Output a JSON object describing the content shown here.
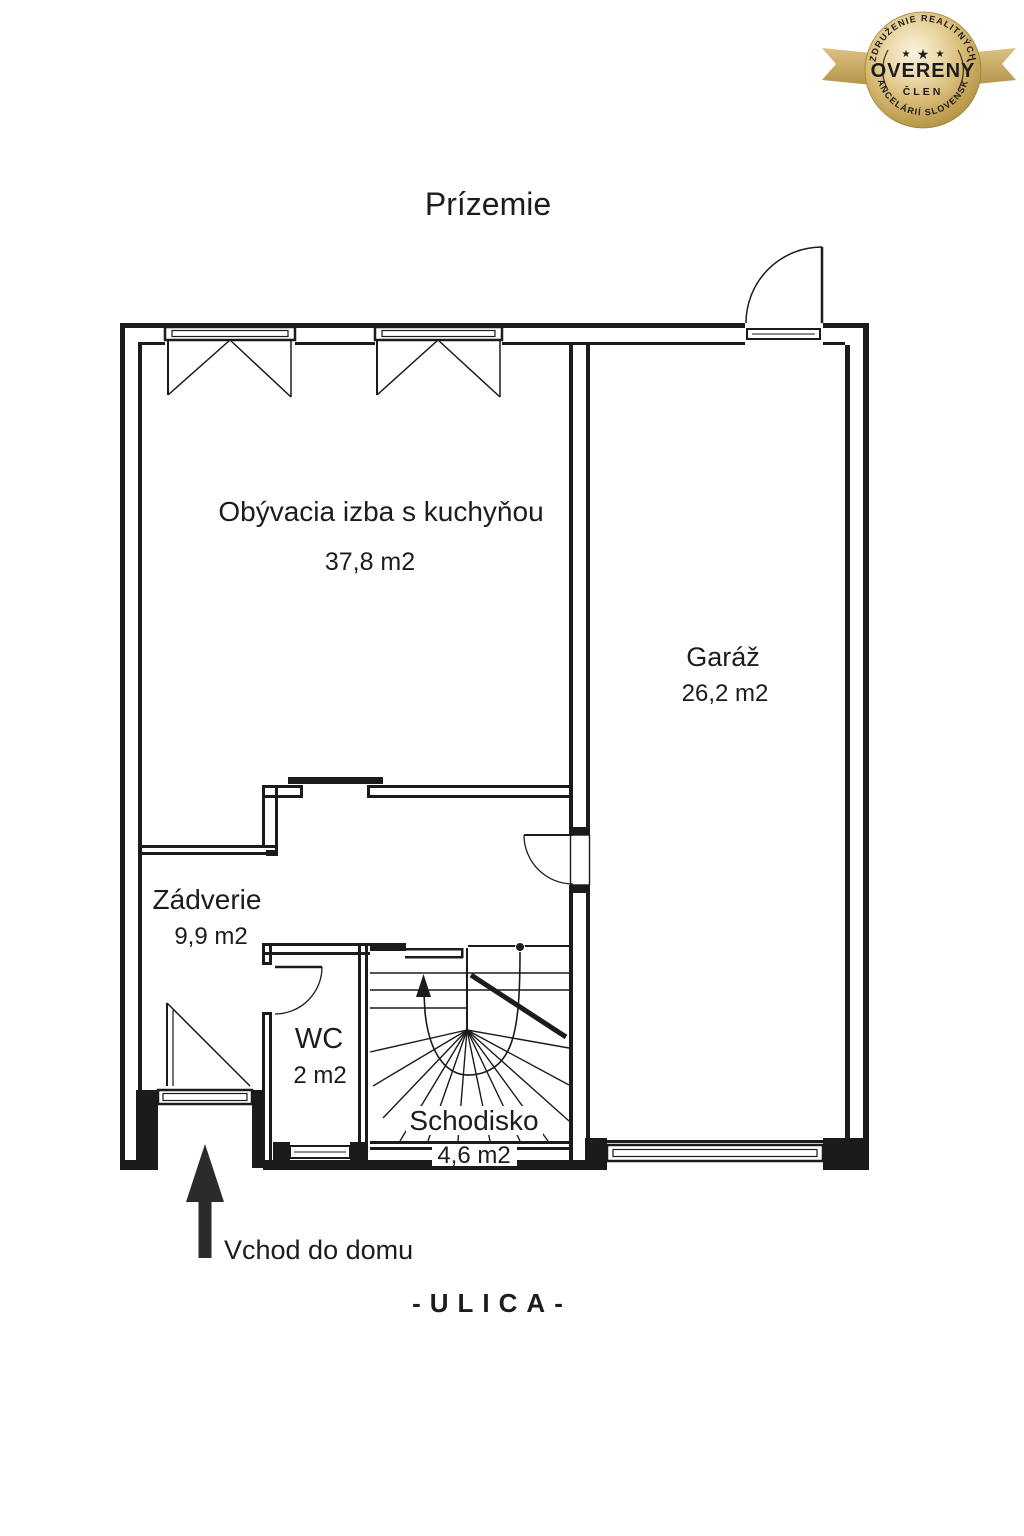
{
  "page": {
    "title": "Prízemie",
    "entrance_label": "Vchod do domu",
    "street_label": "-ULICA-"
  },
  "rooms": {
    "living": {
      "name": "Obývacia izba s kuchyňou",
      "area": "37,8 m2"
    },
    "garage": {
      "name": "Garáž",
      "area": "26,2 m2"
    },
    "hall": {
      "name": "Zádverie",
      "area": "9,9 m2"
    },
    "wc": {
      "name": "WC",
      "area": "2 m2"
    },
    "staircase": {
      "name": "Schodisko",
      "area": "4,6 m2"
    }
  },
  "badge": {
    "main": "OVERENÝ",
    "member": "ČLEN",
    "arc_top": "ZDRUŽENIE REALITNÝCH",
    "arc_bottom": "KANCELÁRIÍ SLOVENSKA",
    "stars": "★"
  },
  "colors": {
    "line": "#1b1b1b",
    "badge_gold": "#d9bc78",
    "badge_gold_dark": "#a8893c",
    "badge_text": "#241d10"
  }
}
